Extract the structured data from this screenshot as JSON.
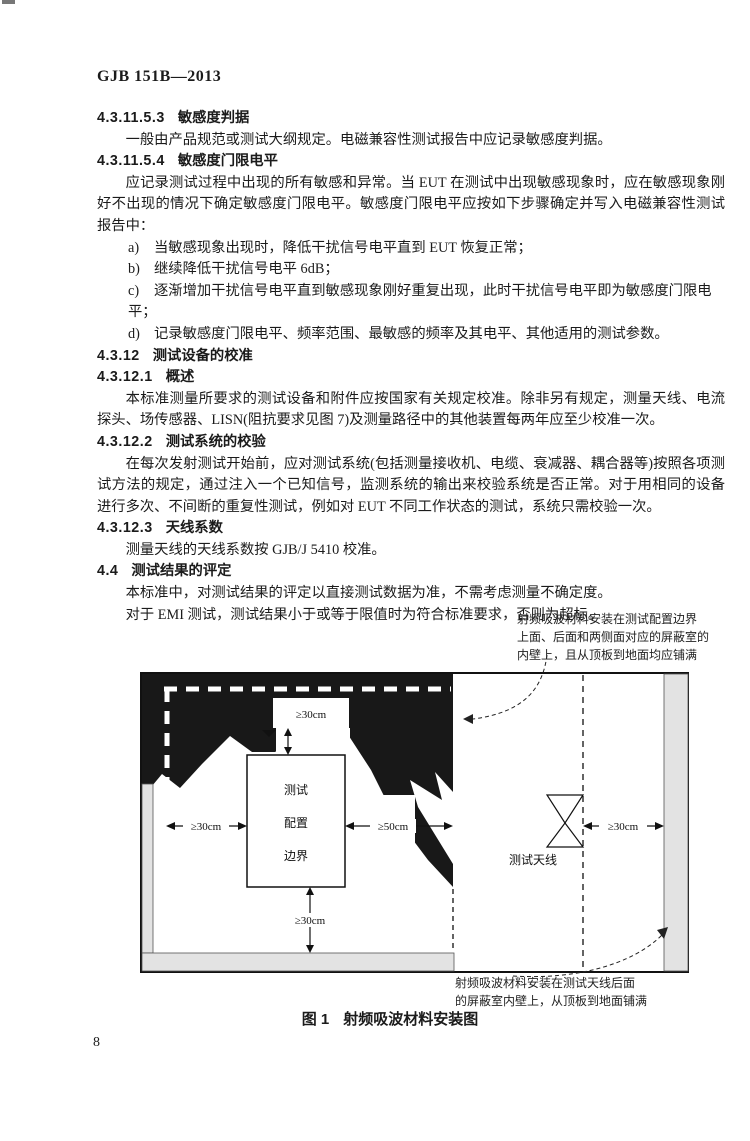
{
  "page": {
    "header": "GJB 151B—2013",
    "page_number": "8"
  },
  "sections": [
    {
      "type": "heading",
      "num": "4.3.11.5.3",
      "title": "敏感度判据"
    },
    {
      "type": "para",
      "text": "一般由产品规范或测试大纲规定。电磁兼容性测试报告中应记录敏感度判据。"
    },
    {
      "type": "heading",
      "num": "4.3.11.5.4",
      "title": "敏感度门限电平"
    },
    {
      "type": "para",
      "text": "应记录测试过程中出现的所有敏感和异常。当 EUT 在测试中出现敏感现象时，应在敏感现象刚好不出现的情况下确定敏感度门限电平。敏感度门限电平应按如下步骤确定并写入电磁兼容性测试报告中："
    },
    {
      "type": "item",
      "marker": "a)",
      "text": "当敏感现象出现时，降低干扰信号电平直到 EUT 恢复正常；"
    },
    {
      "type": "item",
      "marker": "b)",
      "text": "继续降低干扰信号电平 6dB；"
    },
    {
      "type": "item",
      "marker": "c)",
      "text": "逐渐增加干扰信号电平直到敏感现象刚好重复出现，此时干扰信号电平即为敏感度门限电平；"
    },
    {
      "type": "item",
      "marker": "d)",
      "text": "记录敏感度门限电平、频率范围、最敏感的频率及其电平、其他适用的测试参数。"
    },
    {
      "type": "heading",
      "num": "4.3.12",
      "title": "测试设备的校准"
    },
    {
      "type": "heading",
      "num": "4.3.12.1",
      "title": "概述"
    },
    {
      "type": "para",
      "text": "本标准测量所要求的测试设备和附件应按国家有关规定校准。除非另有规定，测量天线、电流探头、场传感器、LISN(阻抗要求见图 7)及测量路径中的其他装置每两年应至少校准一次。"
    },
    {
      "type": "heading",
      "num": "4.3.12.2",
      "title": "测试系统的校验"
    },
    {
      "type": "para",
      "text": "在每次发射测试开始前，应对测试系统(包括测量接收机、电缆、衰减器、耦合器等)按照各项测试方法的规定，通过注入一个已知信号，监测系统的输出来校验系统是否正常。对于用相同的设备进行多次、不间断的重复性测试，例如对 EUT 不同工作状态的测试，系统只需校验一次。"
    },
    {
      "type": "heading",
      "num": "4.3.12.3",
      "title": "天线系数"
    },
    {
      "type": "para",
      "text": "测量天线的天线系数按 GJB/J 5410 校准。"
    },
    {
      "type": "heading",
      "num": "4.4",
      "title": "测试结果的评定"
    },
    {
      "type": "para",
      "text": "本标准中，对测试结果的评定以直接测试数据为准，不需考虑测量不确定度。"
    },
    {
      "type": "para",
      "text": "对于 EMI 测试，测试结果小于或等于限值时为符合标准要求，否则为超标。"
    }
  ],
  "figure": {
    "note_top": [
      "射频吸波材料安装在测试配置边界",
      "上面、后面和两侧面对应的屏蔽室的",
      "内壁上，且从顶板到地面均应铺满"
    ],
    "note_bottom": [
      "射频吸波材料安装在测试天线后面",
      "的屏蔽室内壁上，从顶板到地面铺满"
    ],
    "labels": {
      "dim_top": "≥30cm",
      "dim_left": "≥30cm",
      "dim_right": "≥50cm",
      "dim_bottom": "≥30cm",
      "dim_antenna_wall": "≥30cm",
      "boundary_line1": "测试",
      "boundary_line2": "配置",
      "boundary_line3": "边界",
      "antenna": "测试天线"
    },
    "caption_num": "图 1",
    "caption_title": "射频吸波材料安装图"
  }
}
